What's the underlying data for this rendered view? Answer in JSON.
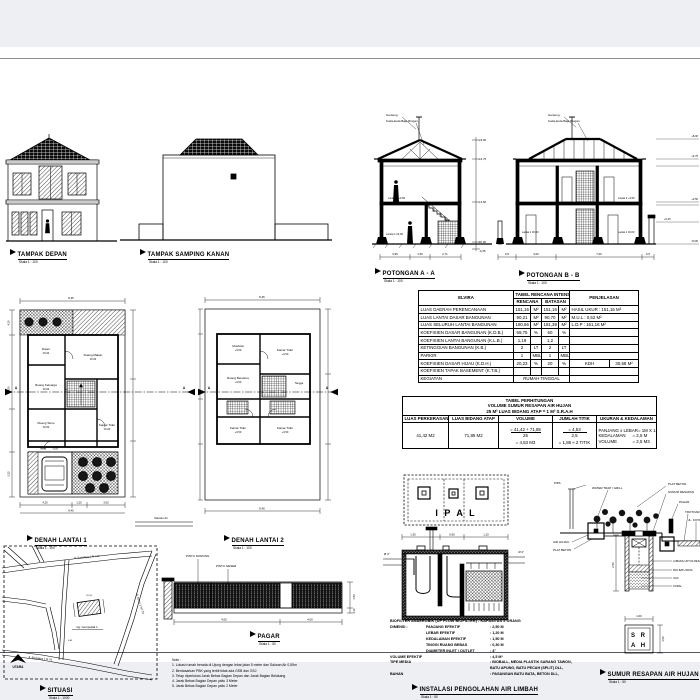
{
  "views": {
    "tampak_depan": {
      "title": "TAMPAK DEPAN",
      "scale": "Skala 1 : 100"
    },
    "tampak_samping_kanan": {
      "title": "TAMPAK SAMPING KANAN",
      "scale": "Skala 1 : 100"
    },
    "potongan_a": {
      "title": "POTONGAN A - A",
      "scale": "Skala 1 : 100",
      "label_genteng": "Genteng",
      "label_kuda": "Kuda-kuda Baja Ringan",
      "label_lantai2": "Lantai 2  +3,50",
      "label_lantai1": "Lantai 1  ±0,00",
      "levels": [
        "+8,00",
        "+6,75",
        "+3,50",
        "±0,00",
        "-0,45"
      ],
      "dims": [
        "3,95",
        "1,50",
        "2,71"
      ]
    },
    "potongan_b": {
      "title": "POTONGAN B - B",
      "scale": "Skala 1 : 100",
      "label_genteng": "Genteng",
      "label_kuda": "Kuda-kuda Baja Ringan",
      "label_lantai2": "Lantai 2  +3,50",
      "label_lantai1a": "Lantai 1  ±0,00",
      "label_lantai1b": "Lantai 1  ±0,00",
      "levels": [
        "+8,00",
        "+6,75",
        "+3,50",
        "±0,00"
      ],
      "right_level": "+0,45",
      "dims": [
        "0,5",
        "3,00",
        "7,00",
        "0,5"
      ]
    },
    "denah1": {
      "title": "DENAH LANTAI 1",
      "scale": "Skala 1 : 100",
      "rooms": [
        {
          "name": "Dapur",
          "elev": "±0,00"
        },
        {
          "name": "Ruang Makan",
          "elev": "±0,00"
        },
        {
          "name": "Ruang Keluarga",
          "elev": "±0,00"
        },
        {
          "name": "Ruang Tamu",
          "elev": "±0,00"
        },
        {
          "name": "Kamar Tidur",
          "elev": "±0,00"
        },
        {
          "name": "Teras",
          "elev": "-0,05"
        }
      ],
      "saluran": "Saluran Air",
      "dim_top": "8,45",
      "dims_bottom": [
        "4,20",
        "1,25",
        "3,00"
      ],
      "dim_overall": "8,45",
      "dims_left": [
        "4,20",
        "9,00",
        "5,25"
      ],
      "cut_letter": "A"
    },
    "denah2": {
      "title": "DENAH LANTAI 2",
      "scale": "Skala 1 : 100",
      "rooms": [
        {
          "name": "Mushola",
          "elev": "+3,50"
        },
        {
          "name": "Kamar Tidur",
          "elev": "+3,50"
        },
        {
          "name": "Ruang Bersama",
          "elev": "+3,50"
        },
        {
          "name": "Tangga",
          "elev": ""
        },
        {
          "name": "Kamar Tidur",
          "elev": "+3,50"
        },
        {
          "name": "Kamar Tidur",
          "elev": "+3,50"
        }
      ],
      "dim_top": "8,45",
      "dim_bottom": "8,45",
      "cut_letter": "A"
    },
    "situasi": {
      "title": "SITUASI",
      "scale": "Skala 1 : 1000",
      "road_top": "Jl. Swadaya 1 N / 14",
      "road_right": "Jl. Asem 1 N / 23",
      "road_bottom": "Jl. Swadaya 1 N / 8",
      "alley": "Gg. Gempedak 1",
      "north": "UTARA",
      "dim_building": "20,34",
      "dim_road": "6,65"
    },
    "pagar": {
      "title": "PAGAR",
      "scale": "Skala 1 : 50",
      "label_pintu1": "PINTU DORONG",
      "label_pintu2": "PINTU GESER",
      "dim1": "4,00",
      "dim2": "4,00",
      "dim_h": "1,50",
      "dim_h2": "0,30"
    },
    "ipal": {
      "plan_label": "I P A L",
      "title": "INSTALASI PENGOLAHAN AIR LIMBAH",
      "scale": "Skala 1 : 50",
      "pipe_left": "Ø 4\"",
      "pipe_right": "Ø 4\"",
      "dims_top": [
        "1,30",
        "0,60",
        "1,10"
      ]
    },
    "srah": {
      "title": "SUMUR RESAPAN AIR HUJAN",
      "scale": "Skala 1 : 50",
      "label_pipa": "PIPA",
      "label_watertrap": "WATER TRAP / GRILL",
      "labels_right": [
        "PLAT BETON",
        "SUMUR RESAPAN",
        "PAGAR",
        "TROTOAR",
        "JL. KOTA"
      ],
      "label_air_hujan": "AIR HUJAN",
      "label_bak_beton": "PLAT BETON",
      "labels_well": [
        "LOBANG UNTUK RESAPAN",
        "PAS BATU BATA",
        "IJUK",
        "KORAL"
      ],
      "dim_depth": "2,50",
      "plan_row1": "S R",
      "plan_row2": "A H",
      "plan_dim_w": "1,00",
      "plan_dim_h": "1,00"
    }
  },
  "intensity_table": {
    "corner": "ELVIRA",
    "header": "TABEL RENCANA INTENSITAS",
    "col_rencana": "RENCANA",
    "col_batasan": "BATASAN",
    "col_penjelasan": "PENJELASAN",
    "rows": [
      {
        "label": "LUAS DAERAH PERENCANAAN",
        "r": "151,16",
        "ru": "M²",
        "b": "151,16",
        "bu": "M²",
        "k": "HASIL UKUR : 151,16 M²",
        "k2": ""
      },
      {
        "label": "LUAS LANTAI DASAR BANGUNAN",
        "r": "90,21",
        "ru": "M²",
        "b": "90,70",
        "bu": "M²",
        "k": "M.U.L : 0,52 M²",
        "k2": ""
      },
      {
        "label": "LUAS SELURUH LANTAI BANGUNAN",
        "r": "180,66",
        "ru": "M²",
        "b": "181,39",
        "bu": "M²",
        "k": "L.D.P : 151,16 M²",
        "k2": ""
      },
      {
        "label": "KOEFISIEN DASAR BANGUNAN (K.D.B.)",
        "r": "59,75",
        "ru": "%",
        "b": "60",
        "bu": "%",
        "k": "",
        "k2": ""
      },
      {
        "label": "KOEFISIEN LANTAI BANGUNAN (K.L.B.)",
        "r": "1,19",
        "ru": "",
        "b": "1,2",
        "bu": "",
        "k": "",
        "k2": ""
      },
      {
        "label": "KETINGGIAN BANGUNAN (K.B.)",
        "r": "2",
        "ru": "LT",
        "b": "2",
        "bu": "LT",
        "k": "",
        "k2": ""
      },
      {
        "label": "PARKIR",
        "r": "1",
        "ru": "MBL",
        "b": "1",
        "bu": "MBL",
        "k": "",
        "k2": ""
      },
      {
        "label": "KOEFISIEN DASAR HIJAU (K.D.H.)",
        "r": "20,23",
        "ru": "%",
        "b": "20",
        "bu": "%",
        "k": "KDH",
        "k2": "30,58 M²"
      },
      {
        "label": "KOEFISIEN TAPAK BASEMENT (K.T.B.)",
        "r": "",
        "ru": "",
        "b": "",
        "bu": "",
        "k": "",
        "k2": ""
      }
    ],
    "last_row_label": "KEGIATAN",
    "last_row_value": "RUMAH TINGGAL"
  },
  "srah_table": {
    "title_line1": "TABEL PERHITUNGAN",
    "title_line2": "VOLUME SUMUR RESAPAN AIR HUJAN",
    "title_line3": "25 M² LUAS BIDANG ATAP = 1 M³ S.R.A.H",
    "col1": "LUAS PERKERASAN",
    "col2": "LUAS BIDANG ATAP",
    "col3": "VOLUME",
    "col4": "JUMLAH TITIK",
    "col5": "UKURAN & KEDALAMAN",
    "luas_perkerasan": "41,42 M2",
    "luas_bidang_atap": "71,85 M2",
    "volume_num": "=  41,42 + 71,85",
    "volume_den": "25",
    "volume_result": "=  4,53 M3",
    "titik_num": "=  4,53",
    "titik_den": "2,5",
    "titik_result": "=  1,86 ≈ 2 TITIK",
    "ukuran_rows": [
      {
        "name": "PANJANG x LEBAR",
        "val": "= 1M X 1M"
      },
      {
        "name": "KEDALAMAN",
        "val": "= 2,5 M"
      },
      {
        "name": "VOLUME",
        "val": "= 2,5 M3"
      }
    ]
  },
  "biofilter": {
    "header": "BIOFILTER ANAEROBIK (UP FLOW BIOFILTER) - KAPASITAS 5 ORANG",
    "rows": [
      {
        "c1": "DIMENSI :",
        "c2": "PANJANG EFEKTIF",
        "c3": ":  2,50  M"
      },
      {
        "c1": "",
        "c2": "LEBAR EFEKTIF",
        "c3": ":  1,20  M"
      },
      {
        "c1": "",
        "c2": "KEDALAMAN  EFEKTIF",
        "c3": ":  1,50  M"
      },
      {
        "c1": "",
        "c2": "TINGGI RUANG BEBAS",
        "c3": ":  0,30  M"
      },
      {
        "c1": "",
        "c2": "DIAMETER INLET / OUTLET",
        "c3": ":  4\""
      },
      {
        "c1": "VOLUME EFEKTIF",
        "c2": "",
        "c3": ":  4,5  M³"
      },
      {
        "c1": "TIPE MEDIA",
        "c2": "",
        "c3": ":  BIOBALL, MEDIA PLASTIK SARANG TAWON,"
      },
      {
        "c1": "",
        "c2": "",
        "c3": "    BATU APUNG, BATU PECAH (SPLIT) DLL,"
      },
      {
        "c1": "BAHAN",
        "c2": "",
        "c3": ":  PASANGAN BATU BATA, BETON DLL,"
      }
    ]
  },
  "notes": {
    "title": "Note :",
    "items": [
      "1.   Lokasi rumah berada di Ujung dengan lebar jalan 5 meter dan Saluran Air 0,55m",
      "2.   Berdasarkan PBK yang terbit tidak ada GSB dan GSJ",
      "3.   Tetap diperlukan Jarak Bebas Bagian Depan dan Jarak Bagian Belakang",
      "4.   Jarak Bebas Bagian Depan yaitu 3 Meter",
      "5.   Jarak Bebas Bagian Depan yaitu 2 Meter"
    ]
  }
}
